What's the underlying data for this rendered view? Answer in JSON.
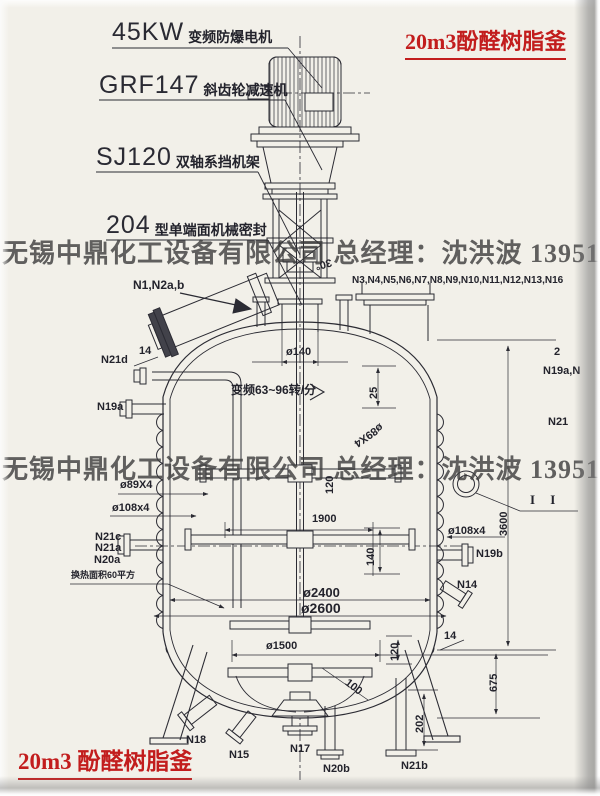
{
  "colors": {
    "ink": "#2b2b33",
    "paper": "#f2f0e9",
    "red": "#c21d1d",
    "watermark_gray": "#3c3c3c"
  },
  "titles": {
    "top_right": "20m3酚醛树脂釜",
    "bottom_left": "20m3 酚醛树脂釜"
  },
  "watermark": {
    "line1": "无锡中鼎化工设备有限公司 总经理：沈洪波 13951588488",
    "line2": "无锡中鼎化工设备有限公司 总经理：沈洪波 13951588488"
  },
  "callouts": [
    {
      "code": "45KW",
      "desc": "变频防爆电机"
    },
    {
      "code": "GRF147",
      "desc": "斜齿轮减速机"
    },
    {
      "code": "SJ120",
      "desc": "双轴系挡机架"
    },
    {
      "code": "204",
      "desc": "型单端面机械密封"
    }
  ],
  "labels": {
    "n1_n2": "N1,N2a,b",
    "n_top_row": "N3,N4,N5,N6,N7,N8,N9,N10,N11,N12,N13,N16",
    "n21d": "N21d",
    "n19a": "N19a",
    "n21c": "N21c",
    "n21a": "N21a",
    "n20a": "N20a",
    "n19b": "N19b",
    "n14": "N14",
    "n18": "N18",
    "n15": "N15",
    "n17": "N17",
    "n20b": "N20b",
    "n21b": "N21b",
    "edge_2": "2",
    "edge_n19a": "N19a,N",
    "edge_n21": "N21"
  },
  "dims": {
    "d140": "ø140",
    "deg30": "30°",
    "d25": "25",
    "d14_left": "14",
    "d14_right": "14",
    "coil_left": "ø89X4",
    "coil_diag": "ø89X4",
    "pipe_left": "ø108x4",
    "pipe_right": "ø108x4",
    "w1900": "1900",
    "h140": "140",
    "d2400": "ø2400",
    "d2600": "ø2600",
    "d1500": "ø1500",
    "l100": "100",
    "h120_upper": "120",
    "h120_lower": "120",
    "h202": "202",
    "h3600": "3600",
    "h675": "675",
    "heat_area": "换热面积60平方",
    "speed": "变频63~96转/分",
    "section": "I  I"
  }
}
